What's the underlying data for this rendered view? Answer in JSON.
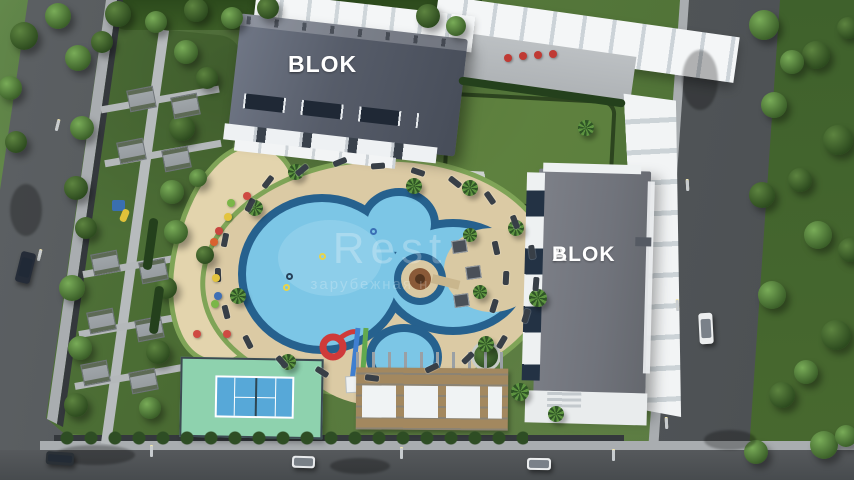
{
  "meta": {
    "description": "Aerial 3D render of residential complex site plan with two apartment blocks, pool, tennis court and gardens"
  },
  "blocks": {
    "b": {
      "line1": "B",
      "line2": "BLOK"
    },
    "a": {
      "line1": "A",
      "line2": "BLOK"
    }
  },
  "watermark": {
    "line1": "Rest",
    "line2": "зарубежная н"
  },
  "colors": {
    "lawn": "#57793c",
    "road": "#4d5154",
    "sidewalk": "#a9adb0",
    "pool_water": "#7cc6e6",
    "pool_edge": "#26618e",
    "deck": "#dbcaa4",
    "roof_b": "#565c69",
    "roof_a": "#75787f",
    "canopy": "#f3f5f6",
    "tennis_outer": "#8ed2ae",
    "tennis_court": "#57a8d8",
    "slide_red": "#cf3a3a",
    "slide_blue": "#3f7fd0",
    "slide_green": "#62a94e",
    "wood": "#a3885f",
    "sand": "#e3d4ad"
  },
  "scene": {
    "trees": [
      {
        "x": 78,
        "y": 58,
        "r": 13,
        "v": "lush"
      },
      {
        "x": 102,
        "y": 42,
        "r": 11,
        "v": "dark"
      },
      {
        "x": 186,
        "y": 52,
        "r": 12,
        "v": "lush"
      },
      {
        "x": 207,
        "y": 78,
        "r": 11,
        "v": "dark"
      },
      {
        "x": 82,
        "y": 128,
        "r": 12,
        "v": "lush"
      },
      {
        "x": 182,
        "y": 128,
        "r": 13,
        "v": "dark"
      },
      {
        "x": 76,
        "y": 188,
        "r": 12,
        "v": "dark"
      },
      {
        "x": 172,
        "y": 192,
        "r": 12,
        "v": "lush"
      },
      {
        "x": 86,
        "y": 228,
        "r": 11,
        "v": "dark"
      },
      {
        "x": 176,
        "y": 232,
        "r": 12,
        "v": "lush"
      },
      {
        "x": 72,
        "y": 288,
        "r": 13,
        "v": "lush"
      },
      {
        "x": 166,
        "y": 288,
        "r": 11,
        "v": "dark"
      },
      {
        "x": 80,
        "y": 348,
        "r": 12,
        "v": "lush"
      },
      {
        "x": 158,
        "y": 352,
        "r": 12,
        "v": "dark"
      },
      {
        "x": 76,
        "y": 405,
        "r": 12,
        "v": "dark"
      },
      {
        "x": 150,
        "y": 408,
        "r": 11,
        "v": "lush"
      },
      {
        "x": 205,
        "y": 255,
        "r": 9,
        "v": "dark"
      },
      {
        "x": 198,
        "y": 178,
        "r": 9,
        "v": "lush"
      },
      {
        "x": 118,
        "y": 14,
        "r": 13,
        "v": "dark"
      },
      {
        "x": 156,
        "y": 22,
        "r": 11,
        "v": "lush"
      },
      {
        "x": 196,
        "y": 10,
        "r": 12,
        "v": "dark"
      },
      {
        "x": 232,
        "y": 18,
        "r": 11,
        "v": "lush"
      },
      {
        "x": 268,
        "y": 8,
        "r": 11,
        "v": "dark"
      },
      {
        "x": 428,
        "y": 16,
        "r": 12,
        "v": "dark"
      },
      {
        "x": 456,
        "y": 26,
        "r": 10,
        "v": "lush"
      },
      {
        "x": 58,
        "y": 16,
        "r": 13,
        "v": "lush"
      },
      {
        "x": 24,
        "y": 36,
        "r": 14,
        "v": "dark"
      },
      {
        "x": 10,
        "y": 88,
        "r": 12,
        "v": "lush"
      },
      {
        "x": 16,
        "y": 142,
        "r": 11,
        "v": "dark"
      },
      {
        "x": 764,
        "y": 25,
        "r": 15,
        "v": "lush"
      },
      {
        "x": 816,
        "y": 55,
        "r": 14,
        "v": "dark"
      },
      {
        "x": 774,
        "y": 105,
        "r": 13,
        "v": "lush"
      },
      {
        "x": 838,
        "y": 140,
        "r": 15,
        "v": "dark"
      },
      {
        "x": 762,
        "y": 195,
        "r": 13,
        "v": "dark"
      },
      {
        "x": 818,
        "y": 235,
        "r": 14,
        "v": "lush"
      },
      {
        "x": 772,
        "y": 295,
        "r": 14,
        "v": "lush"
      },
      {
        "x": 836,
        "y": 335,
        "r": 15,
        "v": "dark"
      },
      {
        "x": 782,
        "y": 395,
        "r": 13,
        "v": "dark"
      },
      {
        "x": 824,
        "y": 445,
        "r": 14,
        "v": "lush"
      },
      {
        "x": 756,
        "y": 452,
        "r": 12,
        "v": "lush"
      },
      {
        "x": 848,
        "y": 28,
        "r": 11,
        "v": "dark"
      },
      {
        "x": 850,
        "y": 250,
        "r": 12,
        "v": "dark"
      },
      {
        "x": 846,
        "y": 436,
        "r": 11,
        "v": "lush"
      },
      {
        "x": 792,
        "y": 62,
        "r": 12,
        "v": "lush"
      },
      {
        "x": 800,
        "y": 180,
        "r": 12,
        "v": "dark"
      },
      {
        "x": 806,
        "y": 372,
        "r": 12,
        "v": "lush"
      }
    ],
    "palms": [
      {
        "x": 296,
        "y": 172,
        "r": 8
      },
      {
        "x": 255,
        "y": 208,
        "r": 8
      },
      {
        "x": 238,
        "y": 296,
        "r": 8
      },
      {
        "x": 288,
        "y": 362,
        "r": 8
      },
      {
        "x": 414,
        "y": 186,
        "r": 8
      },
      {
        "x": 470,
        "y": 188,
        "r": 8
      },
      {
        "x": 516,
        "y": 228,
        "r": 8
      },
      {
        "x": 538,
        "y": 298,
        "r": 9
      },
      {
        "x": 486,
        "y": 344,
        "r": 8
      },
      {
        "x": 520,
        "y": 392,
        "r": 9
      },
      {
        "x": 556,
        "y": 414,
        "r": 8
      },
      {
        "x": 470,
        "y": 235,
        "r": 7
      },
      {
        "x": 480,
        "y": 292,
        "r": 7
      },
      {
        "x": 586,
        "y": 128,
        "r": 8
      }
    ],
    "loungers": {
      "focus": {
        "x": 385,
        "y": 272
      },
      "list": [
        [
          250,
          205
        ],
        [
          225,
          240
        ],
        [
          218,
          275
        ],
        [
          226,
          312
        ],
        [
          248,
          342
        ],
        [
          282,
          362
        ],
        [
          322,
          372
        ],
        [
          268,
          182
        ],
        [
          302,
          170
        ],
        [
          340,
          162
        ],
        [
          378,
          166
        ],
        [
          418,
          172
        ],
        [
          455,
          182
        ],
        [
          490,
          198
        ],
        [
          515,
          222
        ],
        [
          532,
          252
        ],
        [
          536,
          284
        ],
        [
          526,
          316
        ],
        [
          502,
          342
        ],
        [
          468,
          358
        ],
        [
          432,
          368
        ],
        [
          372,
          378
        ],
        [
          496,
          248
        ],
        [
          506,
          278
        ],
        [
          494,
          306
        ]
      ]
    },
    "cabanas": [
      [
        452,
        240
      ],
      [
        466,
        266
      ],
      [
        454,
        294
      ]
    ],
    "floats": [
      {
        "x": 322,
        "y": 256,
        "c": "#e8d44a"
      },
      {
        "x": 286,
        "y": 287,
        "c": "#e8d44a"
      },
      {
        "x": 373,
        "y": 231,
        "c": "#3a6fb5"
      },
      {
        "x": 289,
        "y": 276,
        "c": "#27415a"
      }
    ],
    "toys": [
      {
        "x": 247,
        "y": 196,
        "c": "#cf4a42"
      },
      {
        "x": 231,
        "y": 203,
        "c": "#7ab648"
      },
      {
        "x": 228,
        "y": 217,
        "c": "#e3c43e"
      },
      {
        "x": 219,
        "y": 231,
        "c": "#c8463f"
      },
      {
        "x": 214,
        "y": 242,
        "c": "#d9622f"
      },
      {
        "x": 216,
        "y": 278,
        "c": "#e3c43e"
      },
      {
        "x": 218,
        "y": 296,
        "c": "#3f6fb5"
      },
      {
        "x": 215,
        "y": 304,
        "c": "#7ab648"
      },
      {
        "x": 197,
        "y": 334,
        "c": "#cf4a42"
      },
      {
        "x": 227,
        "y": 334,
        "c": "#cf4a42"
      },
      {
        "x": 508,
        "y": 58,
        "c": "#c03a34"
      },
      {
        "x": 523,
        "y": 56,
        "c": "#c03a34"
      },
      {
        "x": 538,
        "y": 55,
        "c": "#c03a34"
      },
      {
        "x": 553,
        "y": 54,
        "c": "#c03a34"
      }
    ],
    "patios": [
      [
        128,
        88
      ],
      [
        172,
        95
      ],
      [
        118,
        140
      ],
      [
        163,
        148
      ],
      [
        92,
        252
      ],
      [
        140,
        260
      ],
      [
        88,
        310
      ],
      [
        136,
        318
      ],
      [
        82,
        362
      ],
      [
        130,
        370
      ]
    ],
    "hedgebars": [
      {
        "x": 146,
        "y": 218,
        "w": 9,
        "h": 52,
        "rot": 8
      },
      {
        "x": 152,
        "y": 286,
        "w": 9,
        "h": 48,
        "rot": 8
      },
      {
        "x": 458,
        "y": 88,
        "w": 168,
        "h": 8,
        "rot": 8
      }
    ],
    "cars": [
      {
        "x": 18,
        "y": 252,
        "w": 15,
        "h": 31,
        "rot": 14,
        "color": "#252c38",
        "name": "dark-car-left-road"
      },
      {
        "x": 46,
        "y": 452,
        "w": 28,
        "h": 13,
        "rot": 4,
        "color": "#2a3036",
        "name": "dark-car-bottom-road"
      },
      {
        "x": 292,
        "y": 456,
        "w": 23,
        "h": 12,
        "rot": 2,
        "color": "#e8eaec",
        "name": "white-car-bottom-road-1"
      },
      {
        "x": 527,
        "y": 458,
        "w": 24,
        "h": 12,
        "rot": 1,
        "color": "#eceeef",
        "name": "white-car-bottom-road-2"
      },
      {
        "x": 699,
        "y": 313,
        "w": 14,
        "h": 31,
        "rot": -3,
        "color": "#eceeef",
        "name": "white-car-right-road"
      }
    ],
    "shadows": [
      [
        95,
        455,
        40,
        10
      ],
      [
        360,
        466,
        30,
        8
      ],
      [
        26,
        210,
        16,
        26
      ],
      [
        700,
        80,
        18,
        30
      ],
      [
        730,
        440,
        26,
        10
      ]
    ],
    "lamps": [
      {
        "x": 56,
        "y": 120,
        "rot": 14
      },
      {
        "x": 38,
        "y": 250,
        "rot": 14
      },
      {
        "x": 150,
        "y": 446,
        "rot": 0
      },
      {
        "x": 400,
        "y": 448,
        "rot": 0
      },
      {
        "x": 612,
        "y": 450,
        "rot": 0
      },
      {
        "x": 686,
        "y": 180,
        "rot": -3
      },
      {
        "x": 676,
        "y": 300,
        "rot": -3
      },
      {
        "x": 665,
        "y": 418,
        "rot": -3
      }
    ]
  }
}
